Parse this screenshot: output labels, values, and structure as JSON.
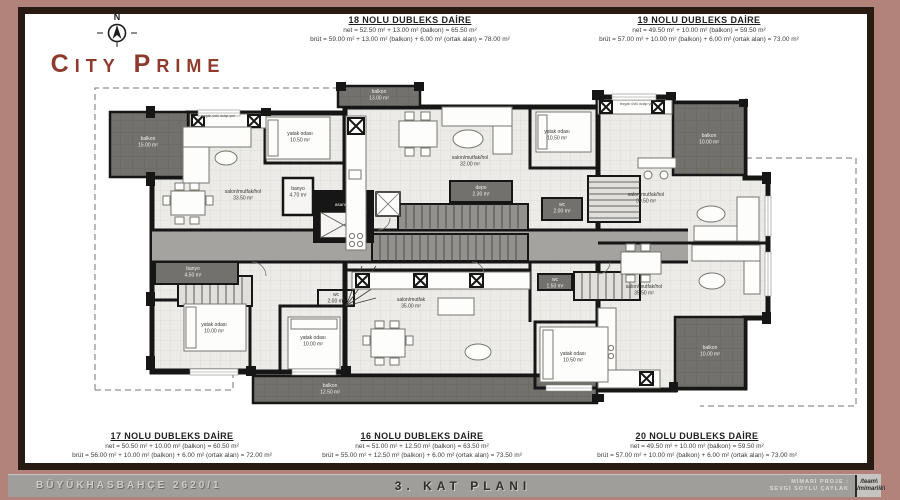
{
  "brand": {
    "name": "City Prime",
    "compass_n": "N"
  },
  "units": {
    "u18": {
      "title": "18 NOLU DUBLEKS DAİRE",
      "net": "net = 52.50 m² + 13.00 m² (balkon) = 65.50 m²",
      "brut": "brüt = 59.00 m² + 13.00 m² (balkon) + 6.00 m² (ortak alan) = 78.00 m²"
    },
    "u19": {
      "title": "19 NOLU DUBLEKS DAİRE",
      "net": "net = 49.50 m² + 10.00 m² (balkon) = 59.50 m²",
      "brut": "brüt = 57.00 m² + 10.00 m² (balkon) + 6.00 m² (ortak alan) = 73.00 m²"
    },
    "u17": {
      "title": "17 NOLU DUBLEKS DAİRE",
      "net": "net = 50.50 m² + 10.00 m² (balkon) = 60.50 m²",
      "brut": "brüt = 56.00 m² + 10.00 m² (balkon) + 6.00 m² (ortak alan) = 72.00 m²"
    },
    "u16": {
      "title": "16 NOLU DUBLEKS DAİRE",
      "net": "net = 51.00 m² + 12.50 m² (balkon) = 63.50 m²",
      "brut": "brüt = 55.00 m² + 12.50 m² (balkon) + 6.00 m² (ortak alan) = 73.50 m²"
    },
    "u20": {
      "title": "20 NOLU DUBLEKS DAİRE",
      "net": "net = 49.50 m² + 10.00 m² (balkon) = 59.50 m²",
      "brut": "brüt = 57.00 m² + 10.00 m² (balkon) + 6.00 m² (ortak alan) = 73.00 m²"
    }
  },
  "footer": {
    "project": "BÜYÜKHASBAHÇE 2620/1",
    "plan_title": "3. KAT PLANI",
    "credit_label": "MİMARİ PROJE :",
    "credit_name": "SEVGİ SOYLU ÇAYLAK",
    "logo_top": "/team\\",
    "logo_bottom": "/mimarlik\\"
  },
  "plan": {
    "elevator_label": "asansör",
    "labels": [
      {
        "t": "balkon",
        "a": "15.00 m²",
        "x": 148,
        "y": 140,
        "c": "light"
      },
      {
        "t": "salon/mutfak/hol",
        "a": "33.50 m²",
        "x": 243,
        "y": 193,
        "c": "dark"
      },
      {
        "t": "yatak odası",
        "a": "10.50 m²",
        "x": 300,
        "y": 135,
        "c": "dark"
      },
      {
        "t": "banyo",
        "a": "4.70 m²",
        "x": 298,
        "y": 190,
        "c": "dark"
      },
      {
        "t": "balkon",
        "a": "13.00 m²",
        "x": 379,
        "y": 93,
        "c": "light"
      },
      {
        "t": "salon/mutfak/hol",
        "a": "32.00 m²",
        "x": 470,
        "y": 159,
        "c": "dark"
      },
      {
        "t": "yatak odası",
        "a": "10.50 m²",
        "x": 557,
        "y": 133,
        "c": "dark"
      },
      {
        "t": "depo",
        "a": "2.30 m²",
        "x": 481,
        "y": 189,
        "c": "light"
      },
      {
        "t": "wc",
        "a": "2.00 m²",
        "x": 562,
        "y": 206,
        "c": "light"
      },
      {
        "t": "salon/mutfak/hol",
        "a": "39.50 m²",
        "x": 646,
        "y": 196,
        "c": "dark"
      },
      {
        "t": "balkon",
        "a": "10.00 m²",
        "x": 709,
        "y": 137,
        "c": "light"
      },
      {
        "t": "banyo",
        "a": "4.50 m²",
        "x": 193,
        "y": 270,
        "c": "light"
      },
      {
        "t": "yatak odası",
        "a": "10.00 m²",
        "x": 214,
        "y": 326,
        "c": "dark"
      },
      {
        "t": "wc",
        "a": "2.00 m²",
        "x": 336,
        "y": 296,
        "c": "dark"
      },
      {
        "t": "yatak odası",
        "a": "10.00 m²",
        "x": 313,
        "y": 339,
        "c": "dark"
      },
      {
        "t": "salon/mutfak",
        "a": "35.00 m²",
        "x": 411,
        "y": 301,
        "c": "dark"
      },
      {
        "t": "wc",
        "a": "1.50 m²",
        "x": 555,
        "y": 281,
        "c": "light"
      },
      {
        "t": "yatak odası",
        "a": "10.50 m²",
        "x": 573,
        "y": 355,
        "c": "dark"
      },
      {
        "t": "salon/mutfak/hol",
        "a": "35.50 m²",
        "x": 644,
        "y": 288,
        "c": "dark"
      },
      {
        "t": "balkon",
        "a": "10.00 m²",
        "x": 710,
        "y": 349,
        "c": "light"
      },
      {
        "t": "balkon",
        "a": "12.50 m²",
        "x": 330,
        "y": 387,
        "c": "light"
      },
      {
        "t": "tezgah üstü dolap yeri",
        "a": "",
        "x": 218,
        "y": 117,
        "c": "note"
      },
      {
        "t": "tezgah üstü dolap yeri",
        "a": "",
        "x": 637,
        "y": 105,
        "c": "note"
      }
    ]
  }
}
